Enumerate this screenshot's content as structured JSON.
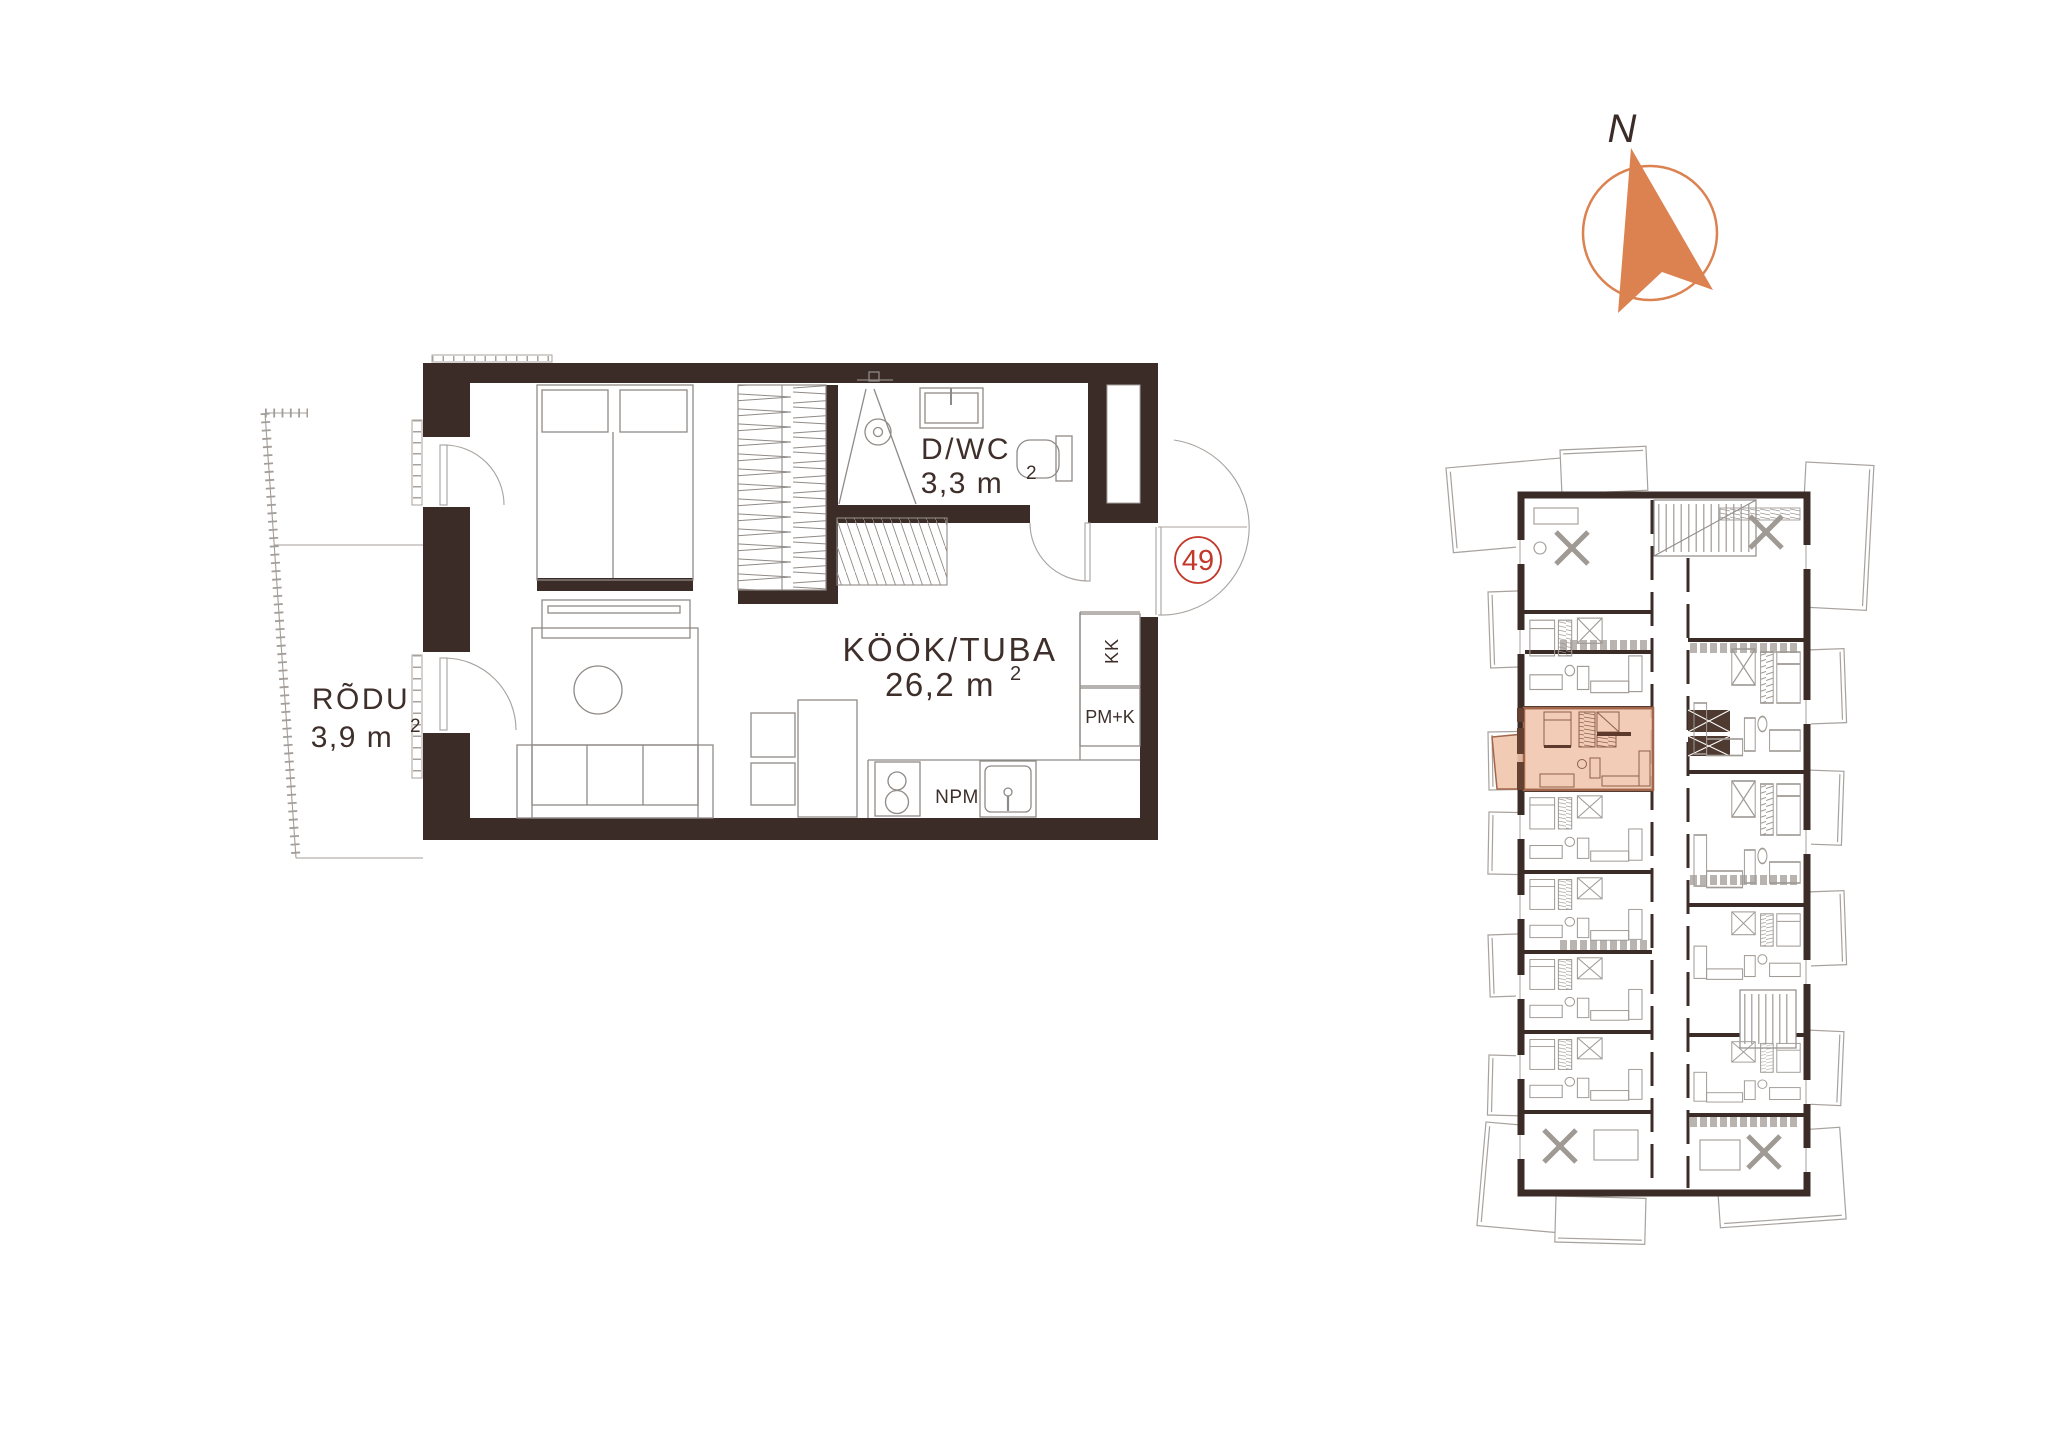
{
  "colors": {
    "wall": "#3B2C28",
    "furniture_line": "#8F8A86",
    "light_line": "#A7A29E",
    "text": "#3E2F2B",
    "unit_badge": "#C2392B",
    "compass": "#DC8150",
    "highlight_fill": "#F0C5AC",
    "highlight_border": "#A2664A"
  },
  "compass": {
    "north_label": "N"
  },
  "floor_plan": {
    "unit_number": "49",
    "rooms": {
      "dwc": {
        "name": "D/WC",
        "area": "3,3 m",
        "area_sup": "2"
      },
      "kook_tuba": {
        "name": "KÖÖK/TUBA",
        "area": "26,2 m",
        "area_sup": "2"
      },
      "rodu": {
        "name": "RÕDU",
        "area": "3,9 m",
        "area_sup": "2"
      }
    },
    "fixture_labels": {
      "kk": "KK",
      "pm_k": "PM+K",
      "npm": "NPM"
    }
  }
}
